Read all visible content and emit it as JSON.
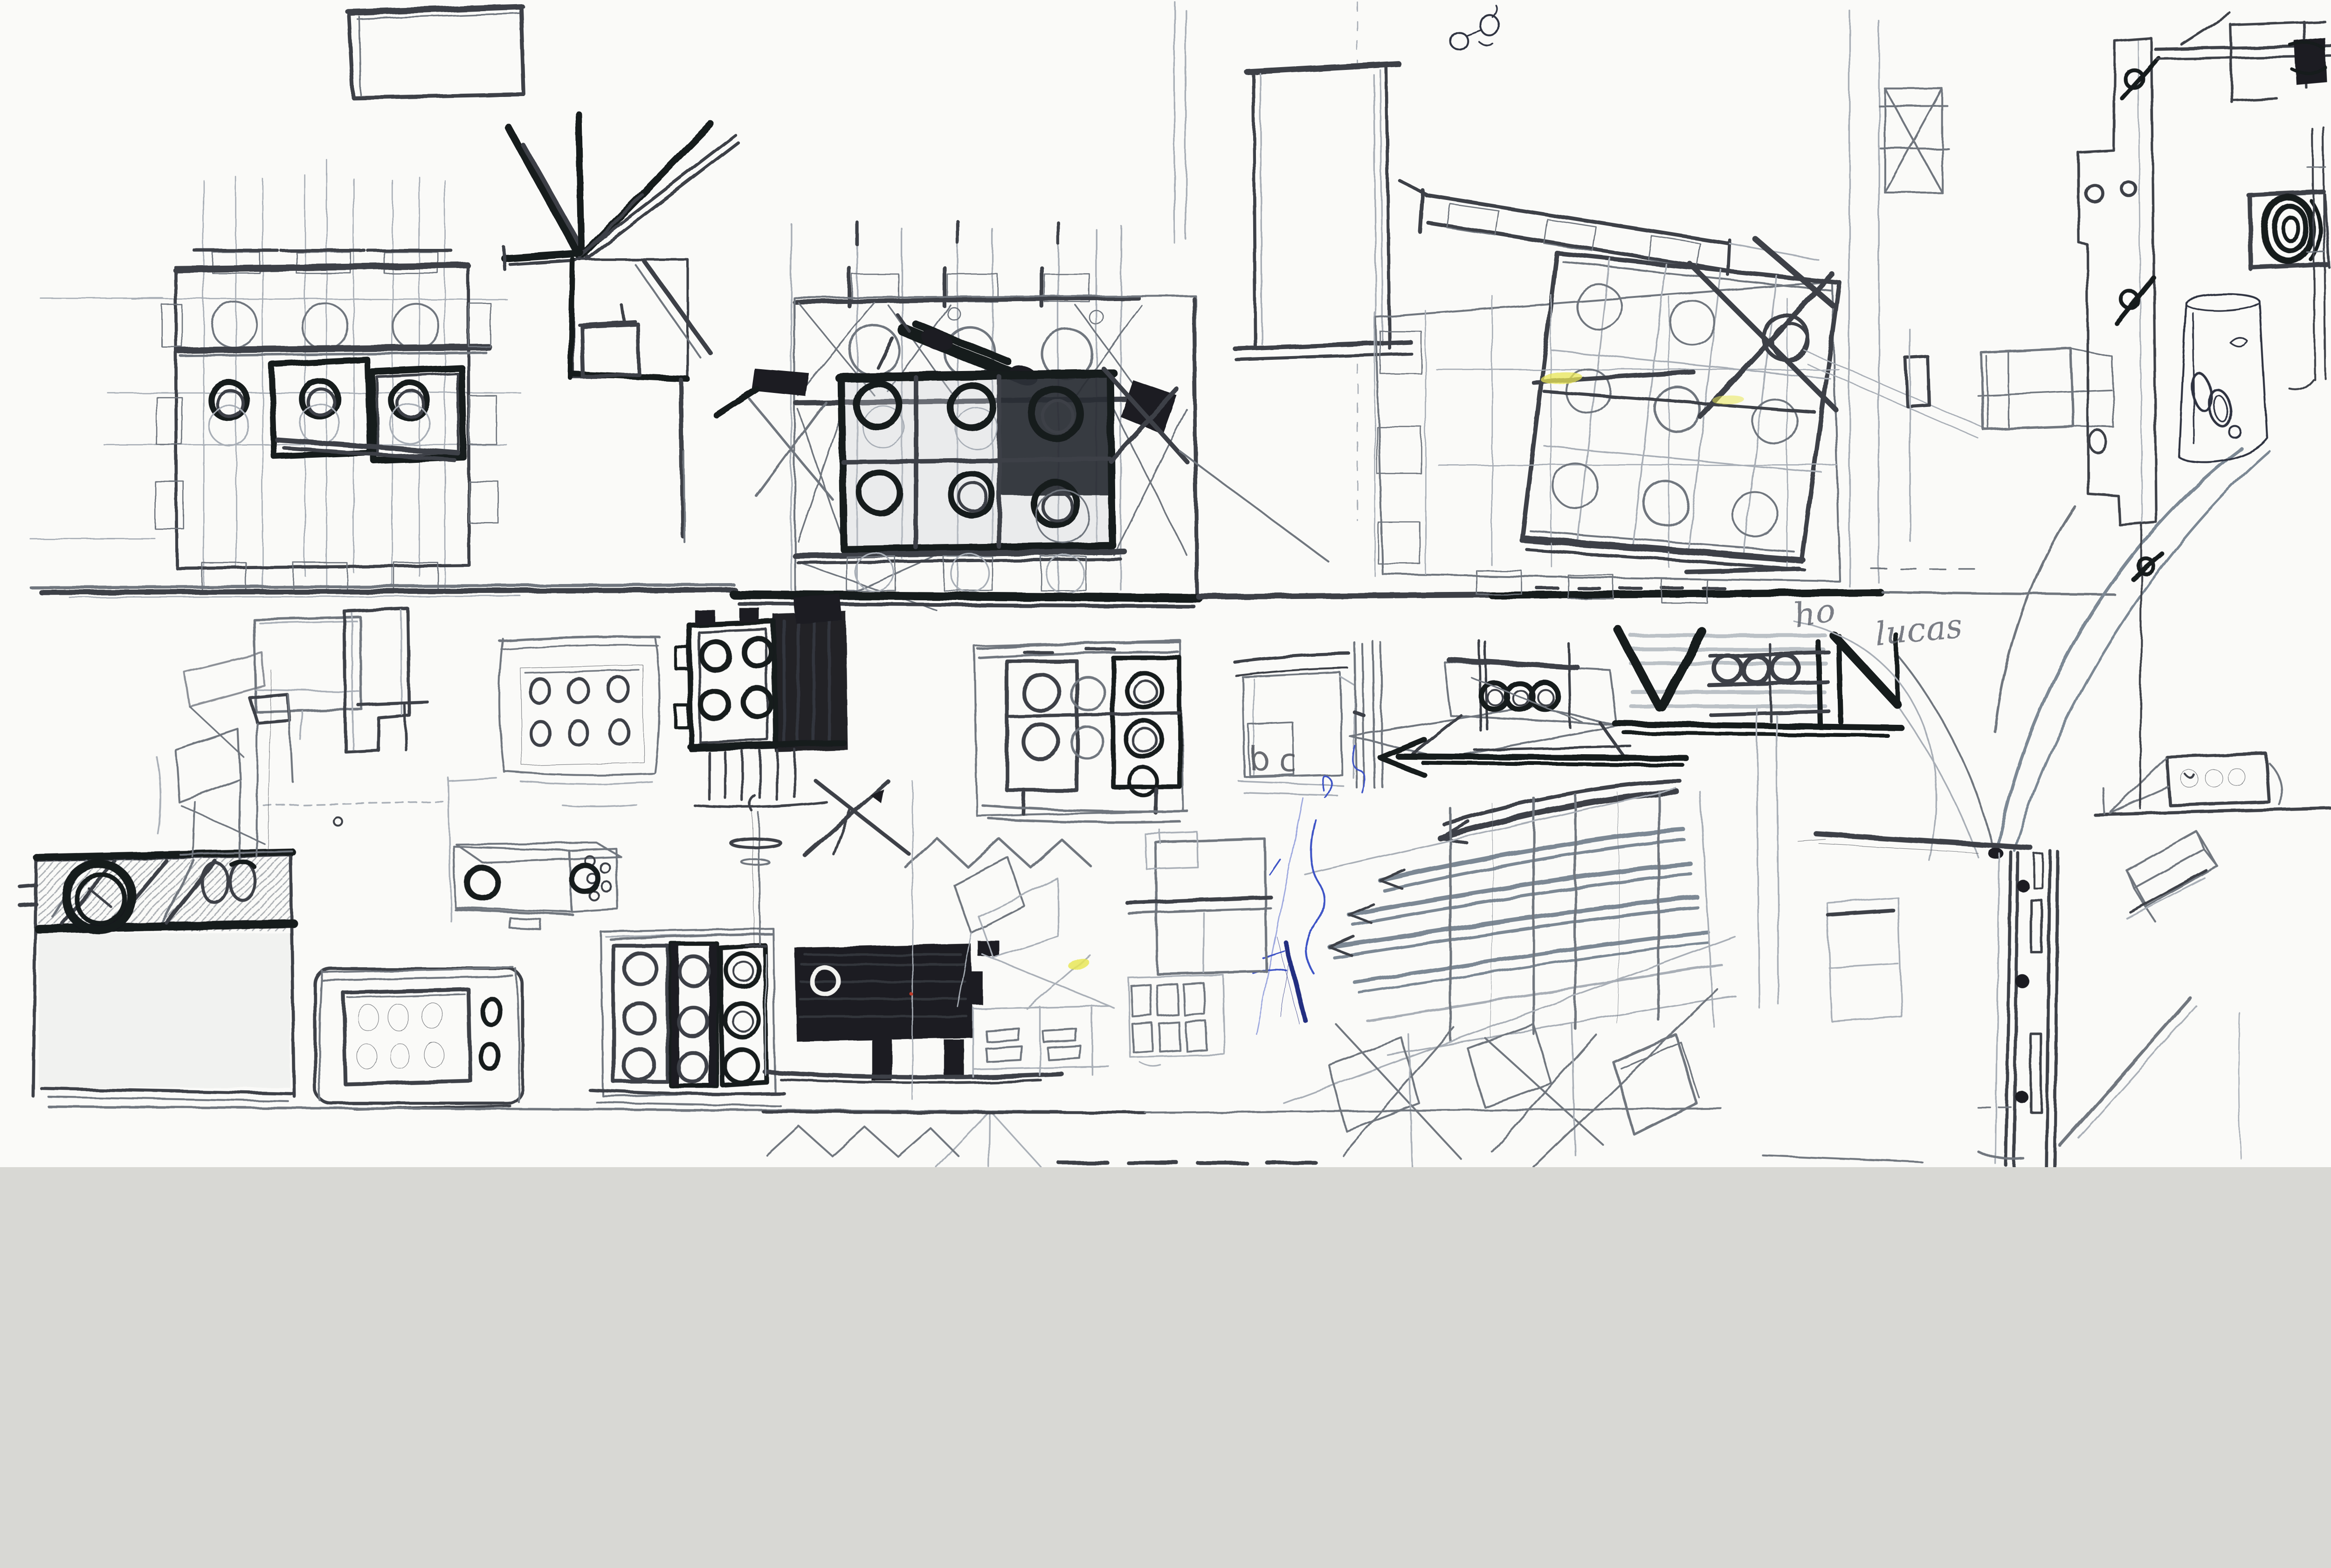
{
  "page": {
    "kind": "scanned sketchbook page of concept sketches",
    "handwriting": {
      "label_b": "b",
      "label_c": "c",
      "word_1": "ho",
      "word_2": "lucas"
    },
    "palette": {
      "paper": "#fafaf8",
      "pencil_light": "#a8aeb6",
      "pencil_mid": "#70767e",
      "pencil_dark": "#3c3f46",
      "graphite_blue": "#7b8894",
      "marker_black": "#191a1e",
      "ballpoint_blue": "#3c52c6",
      "ink_dark_blue": "#232d80",
      "highlighter_yellow": "#e8e657"
    },
    "elements": [
      {
        "id": "top-frame-sketch",
        "label": "empty rectangular frame"
      },
      {
        "id": "gridded-plan-left",
        "label": "modular grid plan with drum units"
      },
      {
        "id": "fan-column-sketch",
        "label": "radial strut column over gridded cell"
      },
      {
        "id": "central-grid-structure",
        "label": "dense modular grid elevation with speaker drums"
      },
      {
        "id": "ground-line",
        "label": "heavy horizontal ground line"
      },
      {
        "id": "portal-frame",
        "label": "tall portal frame"
      },
      {
        "id": "sloped-hatched-band",
        "label": "tilted hatched beam band"
      },
      {
        "id": "tilted-grid-plan",
        "label": "rotated grid plan with circular units and cross brace"
      },
      {
        "id": "perspective-cube",
        "label": "light perspective box study"
      },
      {
        "id": "swoosh-ramp",
        "label": "large sweeping curve ramp"
      },
      {
        "id": "bc-box",
        "label": "small cabinet study lettered b and c"
      },
      {
        "id": "arrow-podium",
        "label": "perspective podium with three drums and left arrow"
      },
      {
        "id": "v-truss-unit",
        "label": "bold V truss with three-drum band"
      },
      {
        "id": "curved-facade",
        "label": "curved multi-storey facade perspective"
      },
      {
        "id": "house-study",
        "label": "small house elevation"
      },
      {
        "id": "window-sheet",
        "label": "sheet with window grid"
      },
      {
        "id": "big-box-left",
        "label": "large cabinet with hatched header and ring"
      },
      {
        "id": "control-panel",
        "label": "rounded control panel with six ovals and two knobs"
      },
      {
        "id": "hatched-chest",
        "label": "hatched chest with ring handles"
      },
      {
        "id": "speaker-cabinet",
        "label": "three-column speaker cabinet"
      },
      {
        "id": "dark-tv",
        "label": "solid black cabinet on legs"
      },
      {
        "id": "antenna-stand",
        "label": "stand with disc"
      },
      {
        "id": "strut-x",
        "label": "crossed strut sketch"
      },
      {
        "id": "kite-frames",
        "label": "light diamond frames"
      },
      {
        "id": "tab-panel",
        "label": "panel with small window tabs"
      },
      {
        "id": "zigzag-row",
        "label": "zigzag roof row"
      },
      {
        "id": "door-jamb",
        "label": "door jamb with bolts and hinges"
      },
      {
        "id": "shelf-speaker-strip",
        "label": "wall shelf with three-drum strip"
      },
      {
        "id": "hatched-brick",
        "label": "hatched brick volume"
      },
      {
        "id": "stepped-wall-panel",
        "label": "stepped wall panel with bolt fixings"
      },
      {
        "id": "corner-frame",
        "label": "corner frame with dark knob"
      },
      {
        "id": "ink-canister",
        "label": "ink-drawn canister with ovals"
      },
      {
        "id": "coil-knob",
        "label": "dark coil knob on bracket"
      },
      {
        "id": "rail-pair",
        "label": "thin vertical rail pair"
      },
      {
        "id": "monitor-sketch",
        "label": "monitor box sketch"
      },
      {
        "id": "step-bracket",
        "label": "stepped bracket panel"
      },
      {
        "id": "chair-sketch",
        "label": "chair easel sketch"
      },
      {
        "id": "ovals-box",
        "label": "box with six-oval faceplate"
      },
      {
        "id": "dark-marker-box",
        "label": "black marker box with four rings"
      },
      {
        "id": "column-speaker-box",
        "label": "pencil box with ring columns"
      },
      {
        "id": "glasses-doodle",
        "label": "small ink doodle"
      },
      {
        "id": "blue-pen-marks",
        "label": "ballpoint scribbles"
      },
      {
        "id": "baseline",
        "label": "long bottom baseline"
      }
    ]
  }
}
